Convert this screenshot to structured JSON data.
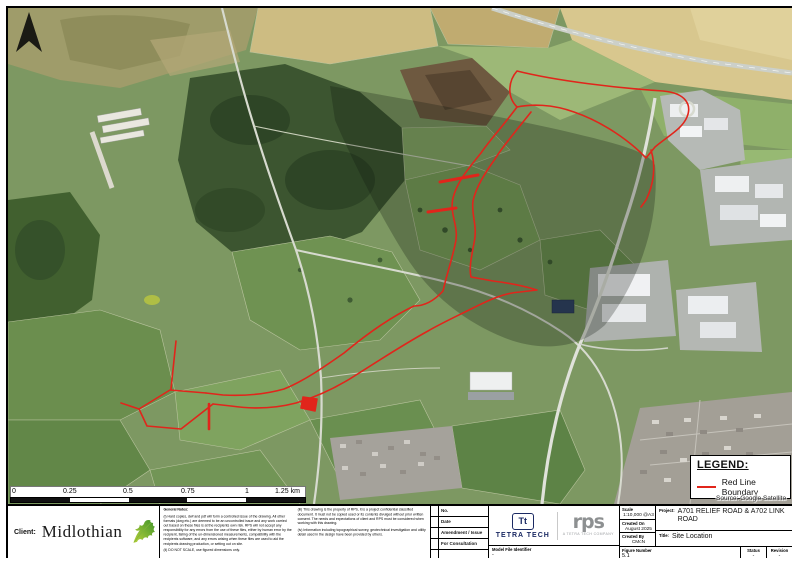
{
  "map": {
    "source_label": "Source: Google Satellite",
    "red_line_color": "#e1251b"
  },
  "icons": {
    "north_arrow": "north-arrow",
    "client_logo": "oak-leaf"
  },
  "legend": {
    "title": "LEGEND:",
    "items": [
      {
        "label": "Red Line Boundary",
        "color": "#e1251b"
      }
    ]
  },
  "scale_bar": {
    "labels": [
      "0",
      "0.25",
      "0.5",
      "0.75",
      "1",
      "1.25 km"
    ]
  },
  "title_block": {
    "client_label": "Client:",
    "client_name": "Midlothian",
    "general_notes": {
      "heading": "General Notes:",
      "note_i": "(i) Hard copies, dwf and pdf will form a controlled issue of the drawing. All other formats (dwg etc.) are deemed to be an uncontrolled issue and any work carried out based on these files is at the recipients own risk. RPS will not accept any responsibility for any errors from the use of these files, either by human error by the recipient, failing of the un-dimensioned measurements, compatibility with the recipients software, and any errors arising when these files are used to aid the recipients drawing production, or setting out on site.",
      "note_ii": "(ii) DO NOT SCALE, use figured dimensions only.",
      "note_iii": "(iii) This drawing is the property of RPS, it is a project confidential classified document. It must not be copied used or its contents divulged without prior written consent. The needs and expectations of client and RPS must be considered when working with this drawing.",
      "note_iv": "(iv) Information including topographical survey, geotechnical investigation and utility detail used in the design have been provided by others."
    },
    "issue_rows": [
      "No.",
      "Date",
      "Amendment / Issue",
      "For Consultation"
    ],
    "logos": {
      "tetra_monogram": "Tt",
      "tetra_name": "TETRA TECH",
      "rps_name": "rps",
      "rps_tagline": "A TETRA TECH COMPANY"
    },
    "model_file": {
      "label": "Model File Identifier",
      "value": "-"
    },
    "fields": {
      "scale_label": "Scale",
      "scale_value": "1:10,000 @A3",
      "created_on_label": "Created On",
      "created_on_value": "August 2025",
      "created_by_label": "Created By",
      "created_by_value": "CMcN",
      "figure_label": "Figure Number",
      "figure_value": "5.1",
      "project_label": "Project:",
      "project_value": "A701 RELIEF ROAD & A702 LINK ROAD",
      "title_label": "Title:",
      "title_value": "Site Location",
      "status_label": "Status",
      "status_value": "-",
      "revision_label": "Revision",
      "revision_value": "-"
    }
  }
}
